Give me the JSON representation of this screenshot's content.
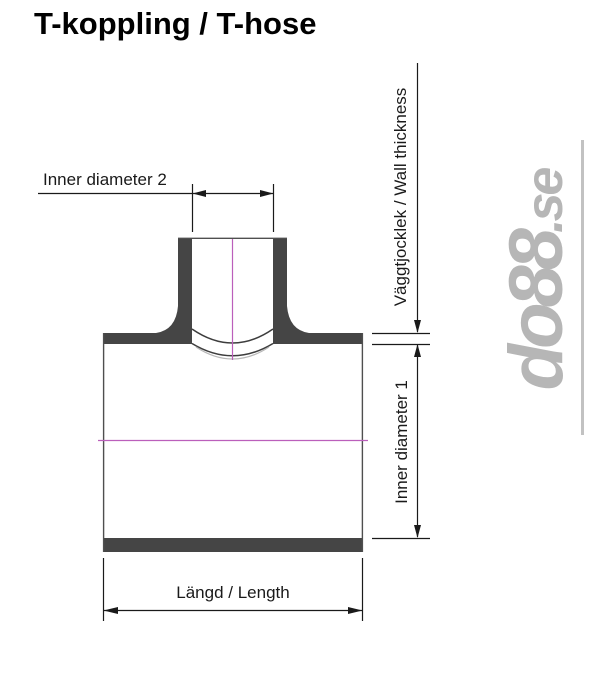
{
  "title": "T-koppling / T-hose",
  "diagram": {
    "type": "technical-dimension-drawing",
    "part": "T-coupling cross section",
    "labels": {
      "inner_diameter_2": "Inner diameter 2",
      "wall_thickness": "Väggtjocklek / Wall thickness",
      "inner_diameter_1": "Inner diameter 1",
      "length": "Längd / Length"
    },
    "colors": {
      "wall_fill": "#454545",
      "outline": "#4f4f4f",
      "arc": "#3d3d3d",
      "arc_faint": "#b8b8b8",
      "dimension": "#1a1a1a",
      "centerline": "#bb5fbb",
      "watermark": "#b6b6b6"
    }
  },
  "watermark": {
    "text": "do88",
    "suffix": ".se"
  }
}
